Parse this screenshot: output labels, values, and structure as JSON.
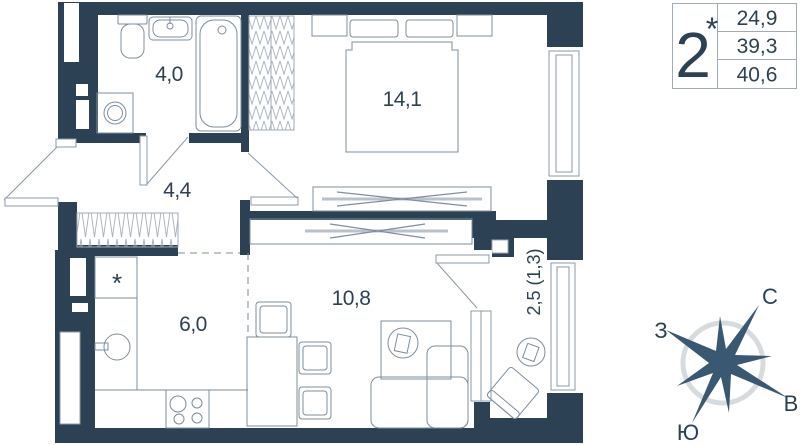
{
  "legend": {
    "number": "2",
    "star": "*",
    "areas": [
      "24,9",
      "39,3",
      "40,6"
    ]
  },
  "rooms": {
    "bathroom": "4,0",
    "bedroom": "14,1",
    "hallway": "4,4",
    "kitchen": "6,0",
    "living_room": "10,8",
    "balcony": "2,5 (1,3)"
  },
  "kitchen_marker": "*",
  "compass": {
    "north": "С",
    "west": "З",
    "east": "В",
    "south": "Ю"
  },
  "colors": {
    "wall": "#2d4155",
    "furniture_line": "#7d8e9e",
    "hatch_line": "#a6b1bb",
    "wardrobe_bar": "#b9c2ca",
    "compass_ring": "#d8dbde",
    "compass_star": "#3a5872",
    "text": "#2d4155"
  }
}
